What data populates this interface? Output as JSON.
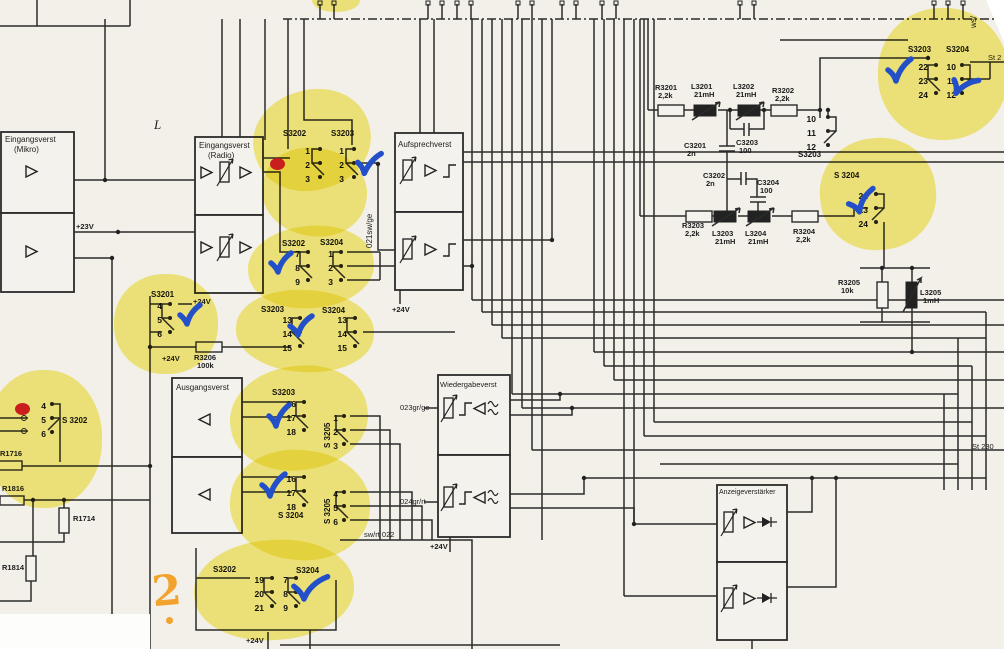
{
  "boxes": {
    "mikro": {
      "line1": "Eingangsverst",
      "line2": "(Mikro)"
    },
    "radio": {
      "line1": "Eingangsverst",
      "line2": "(Radio)"
    },
    "aufsprech": {
      "title": "Aufsprechverst"
    },
    "ausgang": {
      "title": "Ausgangsverst"
    },
    "wiedergabe": {
      "title": "Wiedergabeverst"
    },
    "anzeige": {
      "title": "Anzeigeverstärker"
    }
  },
  "power": {
    "v23": "+23V",
    "v24": "+24V"
  },
  "markers": {
    "l": "L",
    "st2": "St 2",
    "st230": "St 230",
    "ws": "ws/"
  },
  "wire_labels": {
    "w021": "021sw/ge",
    "w022": "sw/rt 022",
    "w023": "023gr/ge",
    "w024": "024gr/rt"
  },
  "components": {
    "r3201": {
      "name": "R3201",
      "value": "2,2k"
    },
    "l3201": {
      "name": "L3201",
      "value": "21mH"
    },
    "l3202": {
      "name": "L3202",
      "value": "21mH"
    },
    "r3202": {
      "name": "R3202",
      "value": "2,2k"
    },
    "c3201": {
      "name": "C3201",
      "value": "2n"
    },
    "c3202": {
      "name": "C3202",
      "value": "2n"
    },
    "c3203": {
      "name": "C3203",
      "value": "100"
    },
    "c3204": {
      "name": "C3204",
      "value": "100"
    },
    "r3203": {
      "name": "R3203",
      "value": "2,2k"
    },
    "l3203": {
      "name": "L3203",
      "value": "21mH"
    },
    "l3204": {
      "name": "L3204",
      "value": "21mH"
    },
    "r3204": {
      "name": "R3204",
      "value": "2,2k"
    },
    "r3205": {
      "name": "R3205",
      "value": "10k"
    },
    "l3205": {
      "name": "L3205",
      "value": "1mH"
    },
    "r3206": {
      "name": "R3206",
      "value": "100k"
    },
    "r1716": {
      "name": "R1716",
      "value": ""
    },
    "r1816": {
      "name": "R1816",
      "value": ""
    },
    "r1714": {
      "name": "R1714",
      "value": ""
    },
    "r1814": {
      "name": "R1814",
      "value": ""
    }
  },
  "switches": {
    "g1a": {
      "label": "S3202",
      "pins": [
        "1",
        "2",
        "3"
      ]
    },
    "g1b": {
      "label": "S3203",
      "pins": [
        "1",
        "2",
        "3"
      ]
    },
    "g2a": {
      "label": "S3202",
      "pins": [
        "7",
        "8",
        "9"
      ]
    },
    "g2b": {
      "label": "S3204",
      "pins": [
        "1",
        "2",
        "3"
      ]
    },
    "g3a": {
      "label": "S3203",
      "pins": [
        "13",
        "14",
        "15"
      ]
    },
    "g3b": {
      "label": "S3204",
      "pins": [
        "13",
        "14",
        "15"
      ]
    },
    "g4": {
      "label": "S3201",
      "pins": [
        "4",
        "5",
        "6"
      ]
    },
    "g5": {
      "label": "S 3202",
      "pins": [
        "4",
        "5",
        "6"
      ]
    },
    "g6a": {
      "label": "S3203",
      "pins": [
        "16",
        "17",
        "18"
      ]
    },
    "g6b": {
      "label": "S 3205",
      "pins": [
        "1",
        "2",
        "3"
      ]
    },
    "g7a": {
      "label": "S 3204",
      "pins": [
        "16",
        "17",
        "18"
      ]
    },
    "g7b": {
      "label": "S 3205",
      "pins": [
        "4",
        "5",
        "6"
      ]
    },
    "g8a": {
      "label": "S3202",
      "pins": [
        "19",
        "20",
        "21"
      ]
    },
    "g8b": {
      "label": "S3204",
      "pins": [
        "7",
        "8",
        "9"
      ]
    },
    "g9a": {
      "label": "S3203",
      "pins": [
        "22",
        "23",
        "24"
      ]
    },
    "g9b": {
      "label": "S3204",
      "pins": [
        "10",
        "11",
        "12"
      ]
    },
    "g10": {
      "label": "S 3204",
      "pins": [
        "22",
        "23",
        "24"
      ]
    },
    "g11": {
      "label": "S3203",
      "pins": [
        "10",
        "11",
        "12"
      ]
    }
  },
  "annotations": {
    "question": "2",
    "colors": {
      "highlight": "#f3e331",
      "check": "#2350c8",
      "dot": "#c91e1e",
      "orange": "#f2a32d"
    }
  }
}
